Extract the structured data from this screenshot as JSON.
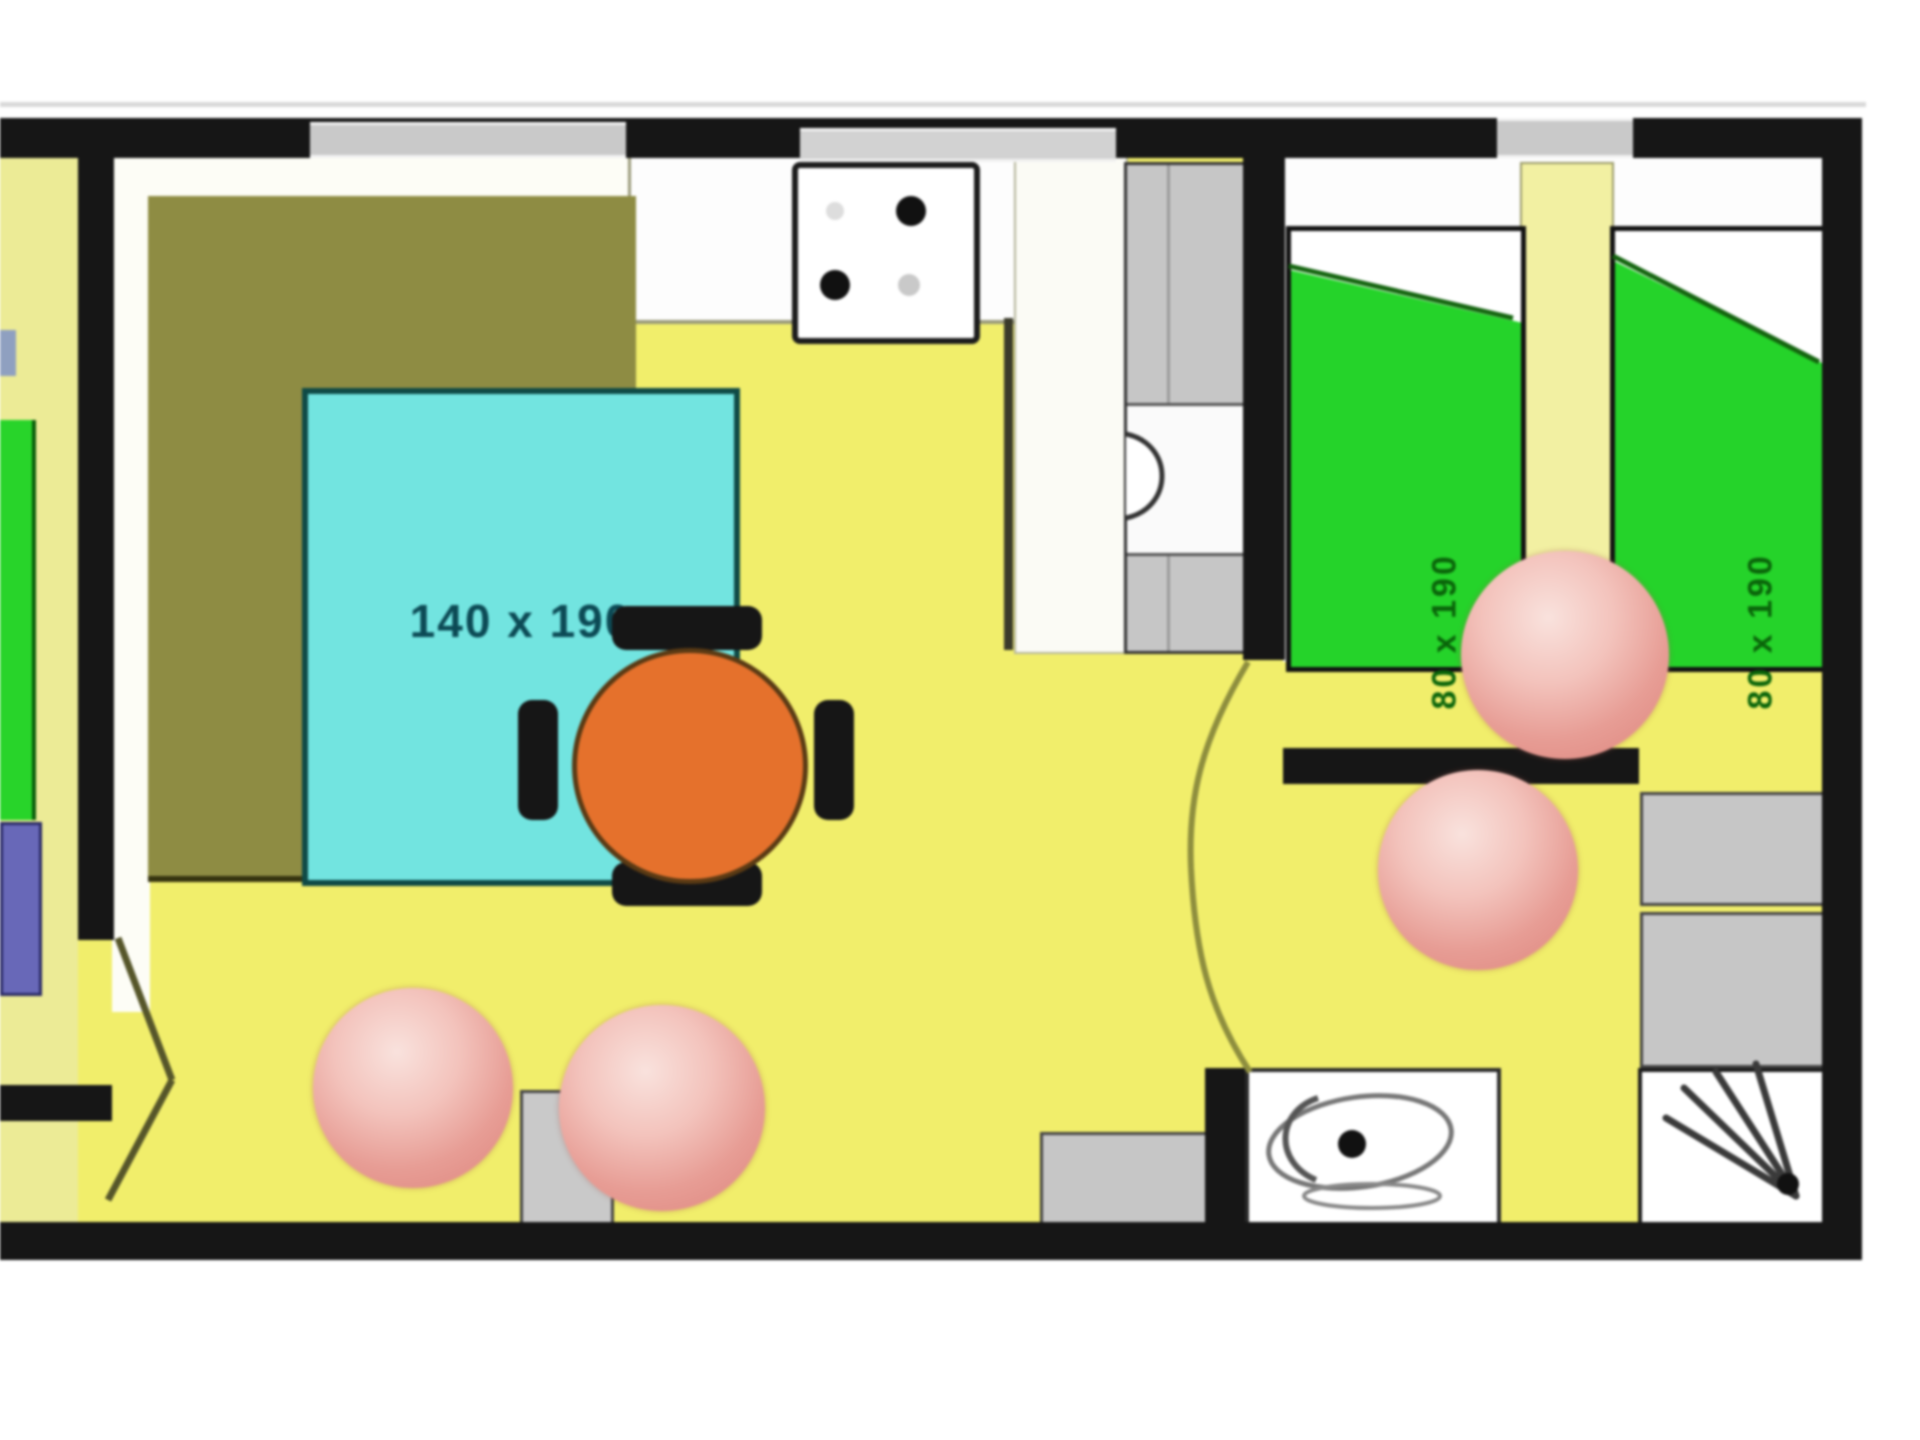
{
  "plan": {
    "type": "mobile-home floor plan",
    "master_bedroom": {
      "bed_label": "140 x 190"
    },
    "kids_bedroom": {
      "bed_left_label": "80 x 190",
      "bed_right_label": "80 x 190"
    },
    "fixtures": [
      "wardrobe",
      "double-bed",
      "stove",
      "kitchen-counter",
      "fridge",
      "dining-table",
      "chairs",
      "single-bed",
      "single-bed",
      "nightstand",
      "washbasin",
      "shower",
      "cabinet",
      "door-swings"
    ],
    "colors": {
      "floor_yellow": "#f1ee6b",
      "floor_pale": "#eceb96",
      "bed_cyan": "#72e4e0",
      "bed_green": "#25d32a",
      "wardrobe_olive": "#8e8c43",
      "table_orange": "#e5712c",
      "ball_pink": "#e79d95",
      "wall_black": "#161616",
      "fixture_gray": "#c6c6c6"
    }
  }
}
